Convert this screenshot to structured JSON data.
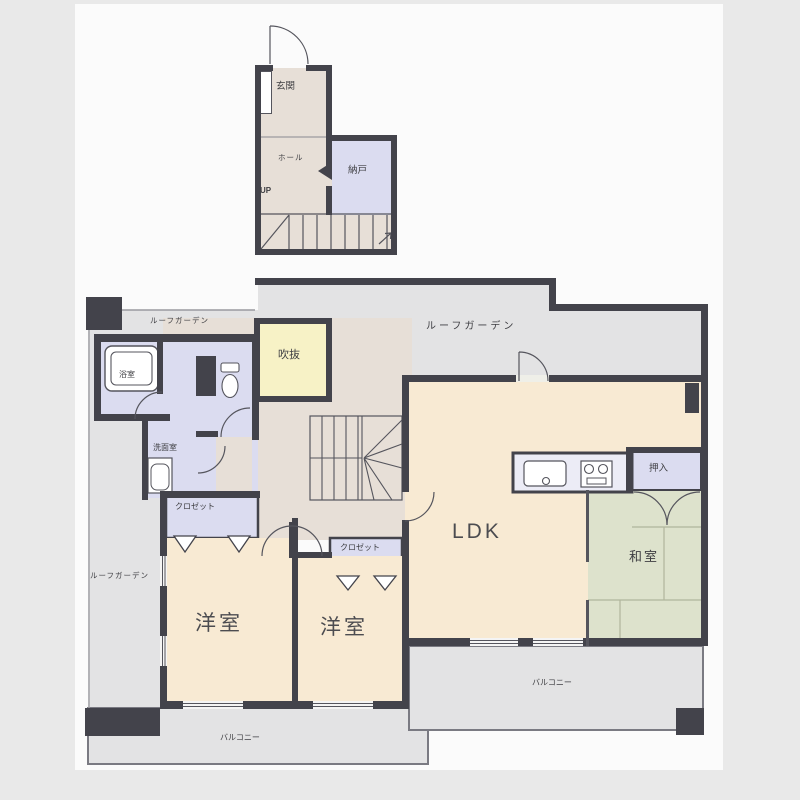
{
  "title": "マンション間取り図 (2-floor maisonette floor plan)",
  "palette": {
    "wall": "#43434b",
    "line": "#55555d",
    "room_cream": "#f8ead3",
    "closet_lavender": "#dbdcf0",
    "tatami_green": "#dde2cc",
    "void_yellow": "#f7f2c6",
    "hall_beige": "#e7dfd7",
    "outdoor_gray": "#e3e3e4",
    "sheet_white": "#fbfbfb",
    "page_gray": "#e9e9e9"
  },
  "floor2": {
    "genkan": "玄関",
    "hall": "ホール",
    "up": "UP",
    "nando": "納戸"
  },
  "floor1": {
    "roof_garden_a": "ルーフガーデン",
    "roof_garden_b": "ルーフガーデン",
    "roof_garden_c": "ルーフガーデン",
    "bath": "浴室",
    "washroom": "洗面室",
    "void": "吹抜",
    "closet_a": "クロゼット",
    "closet_b": "クロゼット",
    "ldk": "LDK",
    "oshiire": "押入",
    "washitsu": "和室",
    "yoshitsu_a": "洋室",
    "yoshitsu_b": "洋室",
    "balcony_a": "バルコニー",
    "balcony_b": "バルコニー"
  }
}
